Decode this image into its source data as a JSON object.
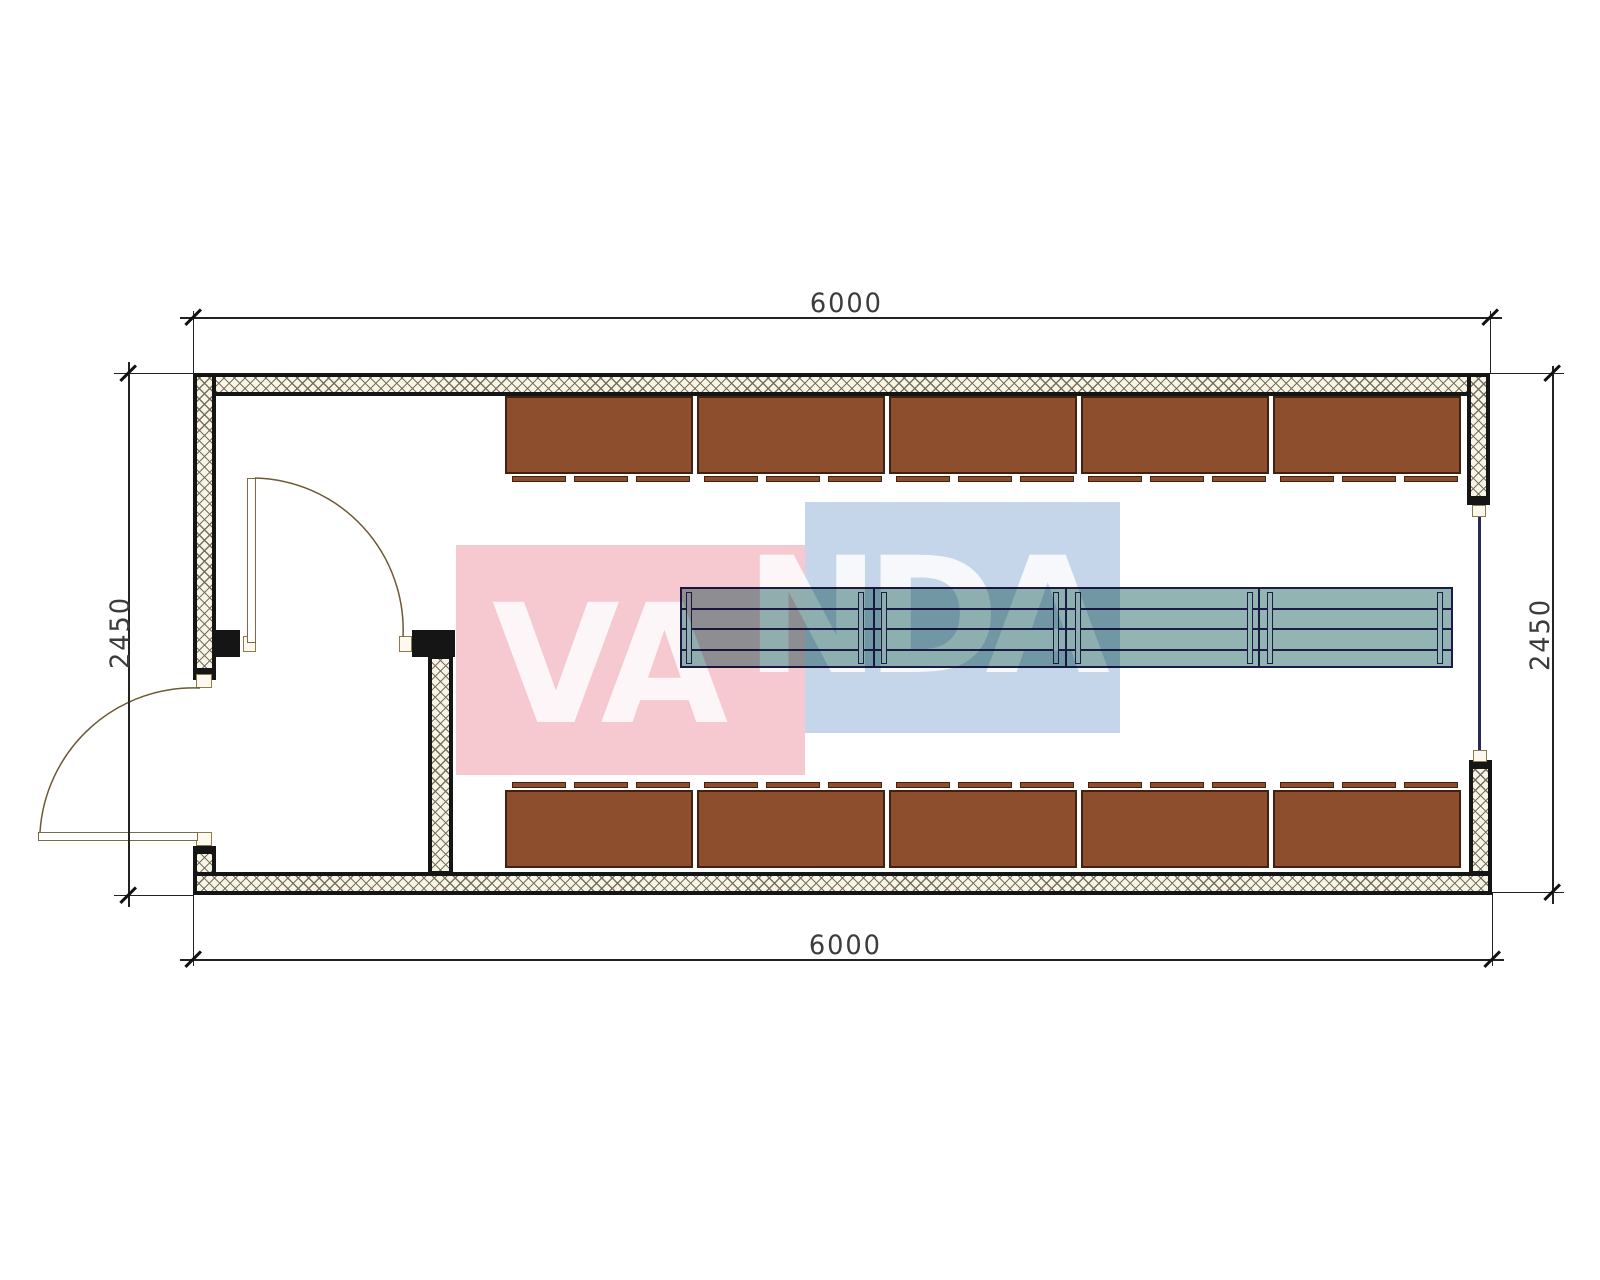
{
  "title": "container-floor-plan",
  "dimensions": {
    "top": "6000",
    "bottom": "6000",
    "left": "2450",
    "right": "2450"
  },
  "watermark": {
    "text_left": "VA",
    "text_right": "NDA",
    "pink_color": "#f6c8d0",
    "blue_color": "#c5d5ea",
    "letter_color": "#ffffff"
  },
  "walls": {
    "hatch_background": "#f8f4e6",
    "hatch_line_color": "#6f6a58",
    "outline_color": "#151515"
  },
  "furniture": {
    "cabinet_color": "#8d4e2e",
    "cabinet_border": "#43200f",
    "cabinet_rows": [
      {
        "position": "top",
        "sections": 5,
        "doors_per_section": 3
      },
      {
        "position": "bottom",
        "sections": 5,
        "doors_per_section": 3
      }
    ],
    "table": {
      "sections": 4,
      "legs": 8,
      "color": "#92b4b3",
      "line_color": "#1c1c46"
    }
  },
  "doors": {
    "exterior_door": "left-wall-swing-out",
    "interior_door": "vestibule-swing-in",
    "frame_color": "#7a6a45"
  },
  "window_line_color": "#2a2a55"
}
